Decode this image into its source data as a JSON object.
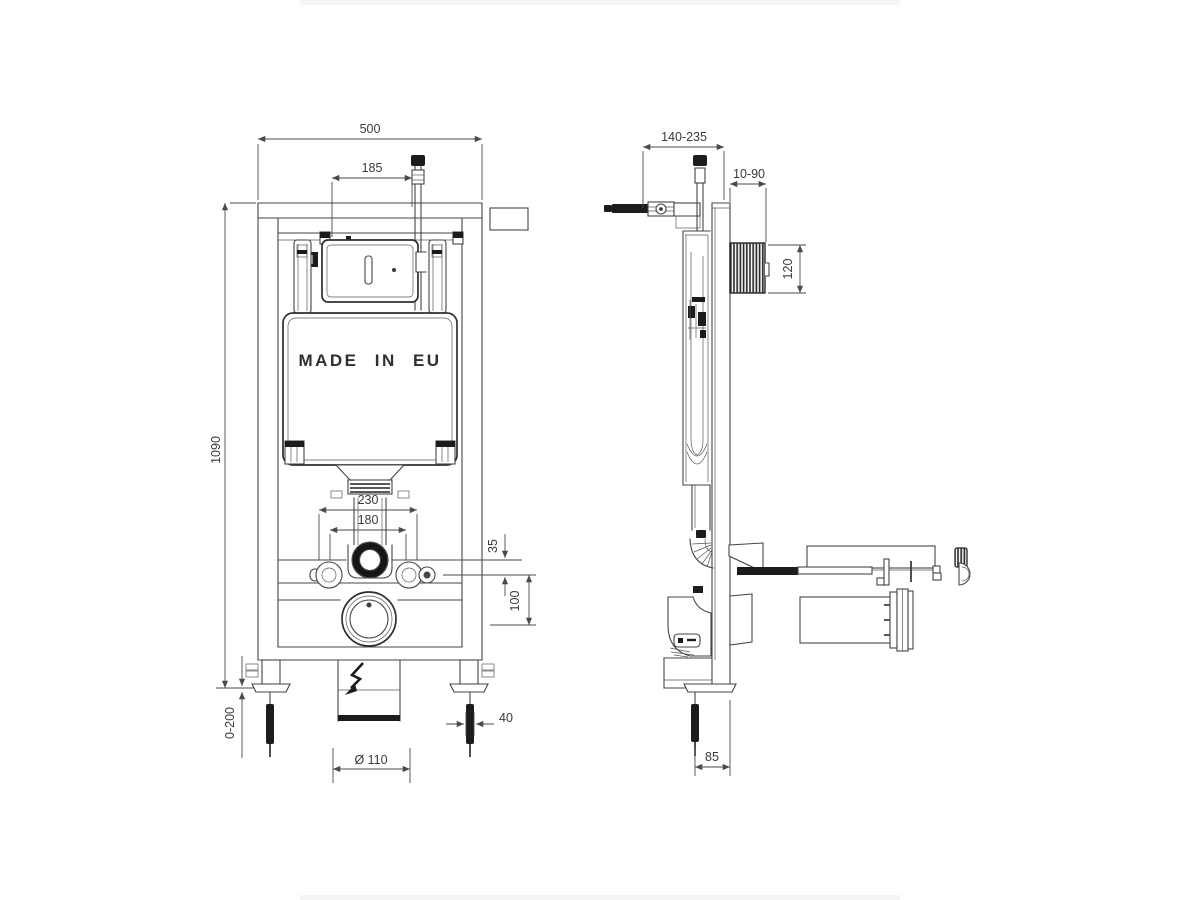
{
  "drawing": {
    "made_in": "MADE IN EU",
    "front": {
      "dims": {
        "width": "500",
        "offset": "185",
        "height": "1090",
        "spacing_outer": "230",
        "spacing_inner": "180",
        "drop_small": "35",
        "drop_large": "100",
        "leg_adjust": "0-200",
        "rod": "40",
        "drain": "Ø 110"
      }
    },
    "side": {
      "dims": {
        "depth": "140-235",
        "wall": "10-90",
        "plate": "120",
        "foot": "85"
      }
    }
  }
}
